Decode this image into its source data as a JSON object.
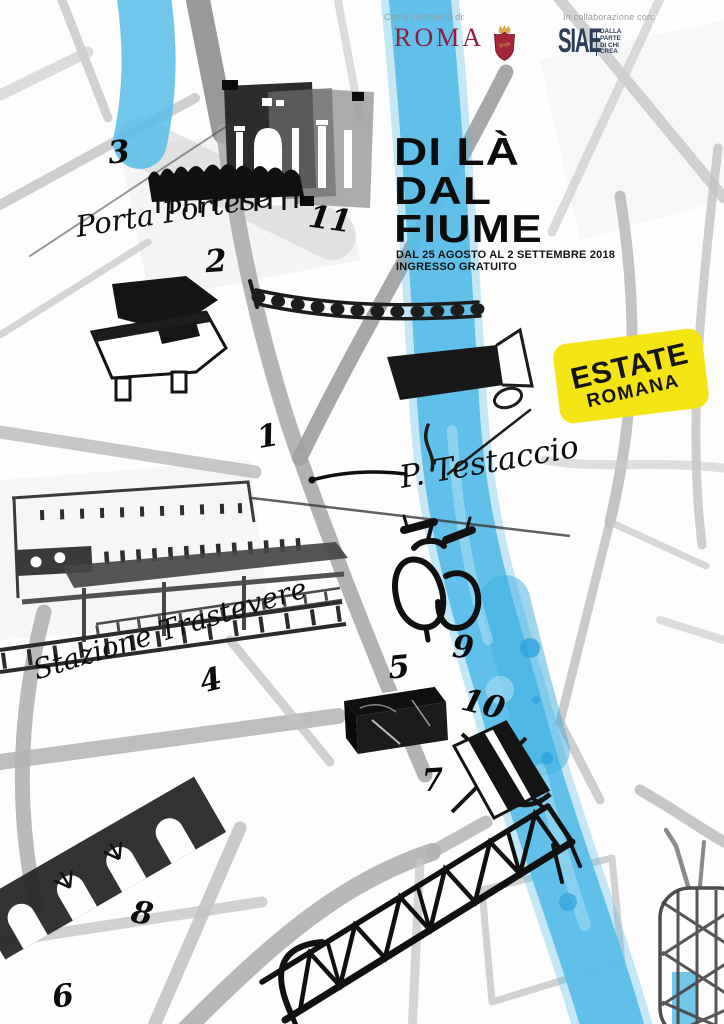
{
  "poster": {
    "header": {
      "contributo_label": "Con il contributo di:",
      "roma_wordmark": "ROMA",
      "roma_shield_text": "SPQR",
      "collaborazione_label": "In collaborazione con:",
      "siae_wordmark": "SIAE",
      "siae_tagline": [
        "DALLA",
        "PARTE",
        "DI CHI",
        "CREA"
      ]
    },
    "title": {
      "line1": "DI LÀ",
      "line2": "DAL",
      "line3": "FIUME"
    },
    "subtitle": {
      "dates": "DAL 25 AGOSTO AL 2 SETTEMBRE 2018",
      "admission": "INGRESSO GRATUITO"
    },
    "badge": {
      "line1": "ESTATE",
      "line2": "ROMANA"
    },
    "map": {
      "labels": [
        {
          "text": "Porta Portese"
        },
        {
          "text": "P. Testaccio"
        },
        {
          "text": "Stazione Trastevere"
        }
      ],
      "markers": [
        {
          "number": "1",
          "x": 268,
          "y": 437,
          "rotate": -10
        },
        {
          "number": "2",
          "x": 216,
          "y": 262,
          "rotate": -4
        },
        {
          "number": "3",
          "x": 119,
          "y": 153,
          "rotate": -6
        },
        {
          "number": "4",
          "x": 211,
          "y": 681,
          "rotate": -14
        },
        {
          "number": "5",
          "x": 399,
          "y": 668,
          "rotate": -6
        },
        {
          "number": "6",
          "x": 63,
          "y": 997,
          "rotate": -8
        },
        {
          "number": "7",
          "x": 433,
          "y": 781,
          "rotate": -4
        },
        {
          "number": "8",
          "x": 142,
          "y": 914,
          "rotate": 10
        },
        {
          "number": "9",
          "x": 463,
          "y": 648,
          "rotate": 4
        },
        {
          "number": "10",
          "x": 483,
          "y": 705,
          "rotate": 14
        },
        {
          "number": "11",
          "x": 330,
          "y": 220,
          "rotate": 8
        }
      ],
      "illustrations": [
        "porta-portese-gate",
        "crowd-silhouette",
        "grand-piano",
        "river-tiber",
        "road-network",
        "bridge-with-railing",
        "vespa-scooter",
        "trastevere-station",
        "railway-tracks",
        "stage-box",
        "deck-chair",
        "arched-bridge",
        "truss-bridge",
        "gasometer"
      ]
    },
    "colors": {
      "river_blue": "#58bde8",
      "badge_yellow": "#f4e414",
      "roma_red": "#8e1f3f",
      "siae_navy": "#2c3e57",
      "ink_black": "#111111",
      "road_gray": "#b5b5b5",
      "label_gray": "#9a9a9a"
    }
  }
}
